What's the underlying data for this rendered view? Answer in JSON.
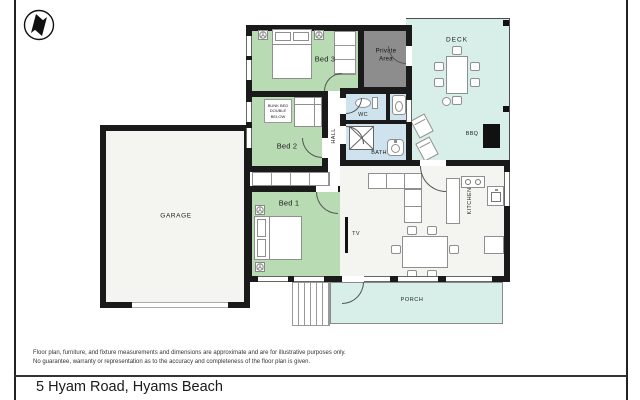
{
  "header": {
    "logo_icon": "north-arrow-compass"
  },
  "floorplan": {
    "labels": {
      "bed1": "Bed 1",
      "bed2": "Bed 2",
      "bed3": "Bed 3",
      "garage": "GARAGE",
      "deck": "DECK",
      "porch": "PORCH",
      "hall": "HALL",
      "kitchen": "KITCHEN",
      "wc": "WC",
      "bath": "BATH",
      "tv": "TV",
      "bbq": "BBQ",
      "private_area": "Private Area",
      "bunk_note": "BUNK BED DOUBLE BELOW"
    },
    "colors": {
      "wall": "#1a1a1a",
      "bedroom_green": "#b9dbb4",
      "outdoor_teal": "#d8efe9",
      "bath_blue": "#cfe3ef",
      "private_gray": "#8d8d8d",
      "floor": "#f4f5f0"
    }
  },
  "footer": {
    "disclaimer_line1": "Floor plan, furniture, and fixture measurements and dimensions are approximate and are for illustrative purposes only.",
    "disclaimer_line2": "No guarantee, warranty or representation as to the accuracy and completeness of the floor plan is given.",
    "address": "5 Hyam Road, Hyams Beach"
  }
}
